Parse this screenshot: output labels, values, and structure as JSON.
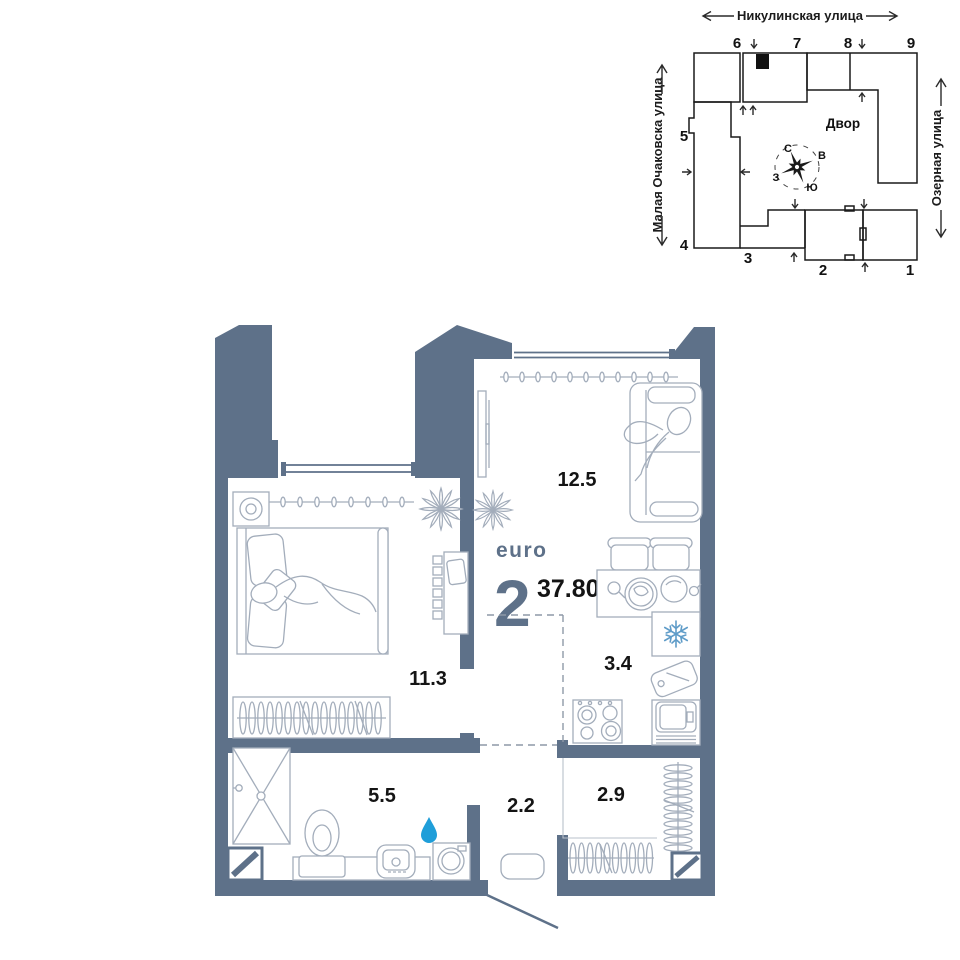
{
  "site_plan": {
    "streets": {
      "top": "Никулинская улица",
      "left": "Малая Очаковска улица",
      "right": "Озерная улица"
    },
    "courtyard": "Двор",
    "compass": {
      "n": "С",
      "e": "В",
      "s": "Ю",
      "w": "З"
    },
    "buildings": {
      "b1": "1",
      "b2": "2",
      "b3": "3",
      "b4": "4",
      "b5": "5",
      "b6": "6",
      "b7": "7",
      "b8": "8",
      "b9": "9"
    },
    "highlighted_building": "7"
  },
  "apartment": {
    "type_label": "euro",
    "rooms_count": "2",
    "total_area": "37.80",
    "areas": {
      "living_room": "12.5",
      "bedroom": "11.3",
      "kitchen": "3.4",
      "bathroom": "5.5",
      "hallway": "2.2",
      "wardrobe": "2.9"
    }
  },
  "colors": {
    "wall": "#5e7189",
    "accent_text": "#5e7189",
    "area_text": "#141414",
    "water_drop": "#1f9ed9",
    "snowflake": "#5f9cc8",
    "highlighted_building_fill": "#e9e9e9"
  }
}
